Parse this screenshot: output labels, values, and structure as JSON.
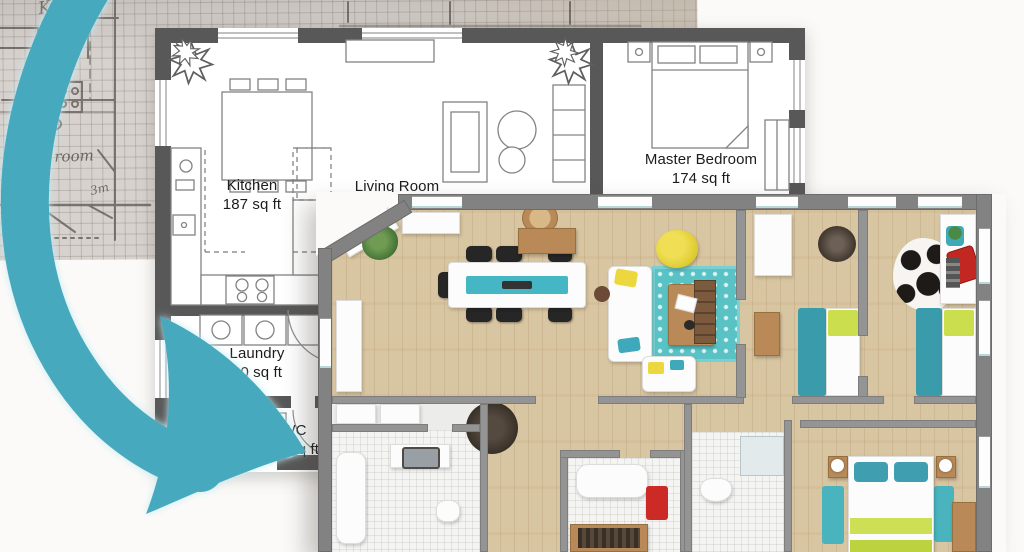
{
  "sketch": {
    "kitchen_label": "Kitchen",
    "utility_label": "Utility room",
    "dimension_label": "3m"
  },
  "plan2d": {
    "rooms": {
      "kitchen": {
        "name": "Kitchen",
        "area": "187 sq ft"
      },
      "living": {
        "name": "Living Room"
      },
      "master": {
        "name": "Master Bedroom",
        "area": "174 sq ft"
      },
      "laundry": {
        "name": "Laundry",
        "area": "60 sq ft"
      },
      "wc": {
        "name": "WC",
        "area": "22 sq ft"
      }
    }
  },
  "colors": {
    "arrow_teal": "#47a9bd",
    "wall_2d": "#585858",
    "wall_3d": "#828282",
    "wood_floor": "#d8c5a1",
    "rug_teal": "#58c2c5",
    "accent_yellow": "#e9d63c",
    "accent_lime": "#cbdf4e",
    "bed_teal": "#3a9cab",
    "accent_red": "#c9281f"
  }
}
